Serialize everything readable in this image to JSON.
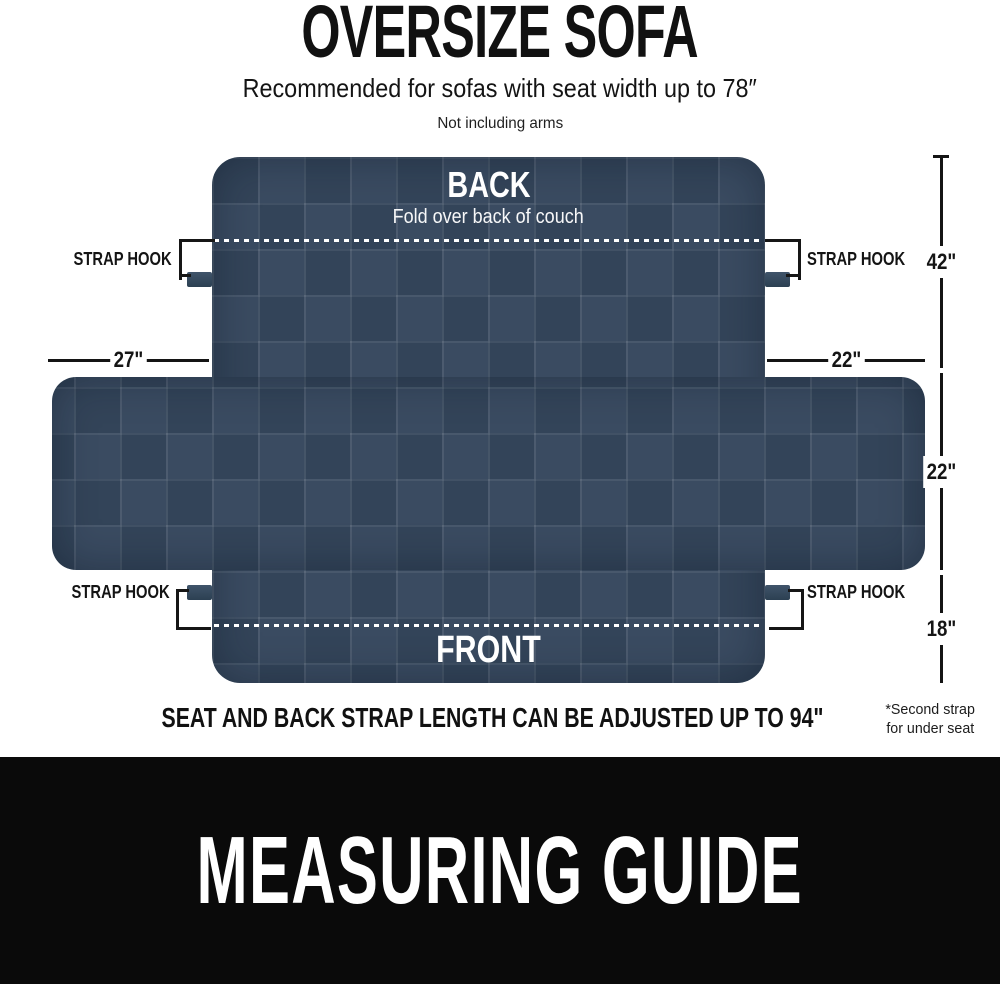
{
  "page": {
    "title": "OVERSIZE SOFA",
    "subtitle": "Recommended for sofas with seat width up to 78″",
    "arms_note": "Not including arms",
    "adjust_note": "SEAT AND BACK STRAP LENGTH CAN BE ADJUSTED UP TO 94\"",
    "footnote_line1": "*Second strap",
    "footnote_line2": "for under seat",
    "banner": "MEASURING GUIDE"
  },
  "diagram": {
    "back_label": "BACK",
    "back_sublabel": "Fold over back of couch",
    "front_label": "FRONT",
    "strap_hook_label": "STRAP HOOK",
    "measurements": {
      "left_flap_width": "27\"",
      "right_flap_width": "22\"",
      "back_section_height": "42\"",
      "middle_section_height": "22\"",
      "front_section_height": "18\""
    },
    "colors": {
      "fabric_navy": "#36475d",
      "fabric_navy_light": "#3a4b61",
      "fabric_navy_dark": "#334459",
      "line_black": "#141414",
      "banner_black": "#0a0a0a",
      "dash_white": "#ffffff"
    }
  }
}
